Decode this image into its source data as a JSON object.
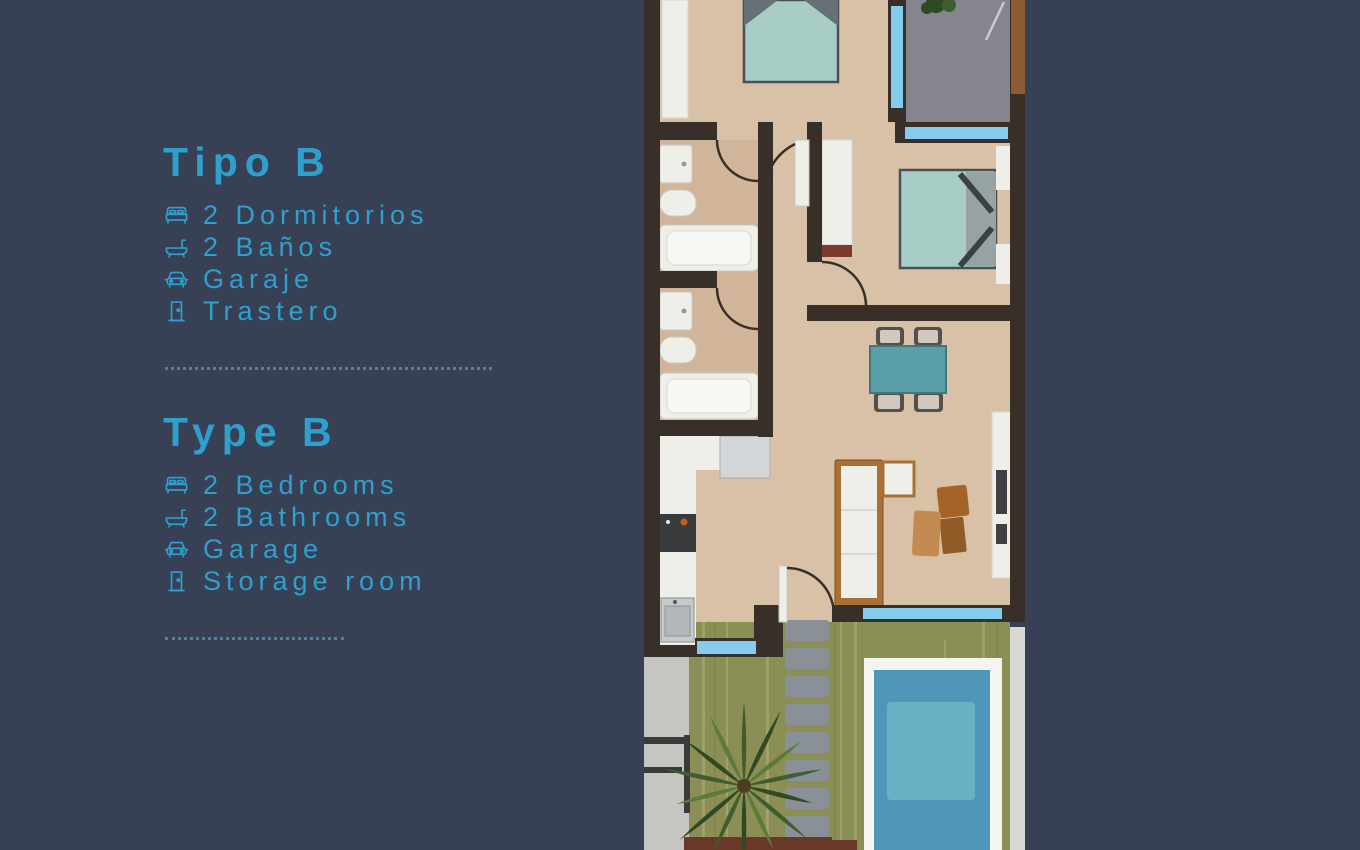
{
  "colors": {
    "bg": "#374054",
    "accent": "#2EA0CE",
    "divider": "#54809F",
    "wall": "#372F28",
    "floor": "#D9C1A8",
    "floor-bath": "#D1B59B",
    "white": "#EFEFEA",
    "window": "#85CBEE",
    "terrace": "#85858D",
    "bed": "#A7CDC6",
    "table": "#5B9FA8",
    "lawn": "#8B8F55",
    "leaf": "#3F5D2E",
    "leaf-dark": "#2F4A22",
    "leaf-light": "#5C7A3A",
    "pool": "#4E97B8",
    "pool-light": "#6FB9C6",
    "deck": "#F4F5F1",
    "stone": "#8A9097",
    "path": "#C5C5C2",
    "wood": "#A96F33",
    "chair-tan": "#C48B51",
    "chair-brown": "#A66328",
    "door-brown": "#8F5B33",
    "planter": "#693828",
    "dark-unit": "#3F4042",
    "gray-unit": "#D3D6D8",
    "headboard": "#667077",
    "railing": "#3A3A3A",
    "red-base": "#7A3B2C",
    "bed-gray": "#97A2A4",
    "chair-seat": "#CFC9C0",
    "chair-frame": "#57504A",
    "stove": "#3A3B3D",
    "steel": "#C6CACB"
  },
  "info_panel": {
    "sections": [
      {
        "heading": "Tipo B",
        "items": [
          {
            "icon": "bed-icon",
            "label": "2 Dormitorios"
          },
          {
            "icon": "bathtub-icon",
            "label": "2 Baños"
          },
          {
            "icon": "car-icon",
            "label": "Garaje"
          },
          {
            "icon": "storage-door-icon",
            "label": "Trastero"
          }
        ]
      },
      {
        "heading": "Type B",
        "items": [
          {
            "icon": "bed-icon",
            "label": "2 Bedrooms"
          },
          {
            "icon": "bathtub-icon",
            "label": "2 Bathrooms"
          },
          {
            "icon": "car-icon",
            "label": "Garage"
          },
          {
            "icon": "storage-door-icon",
            "label": "Storage room"
          }
        ]
      }
    ]
  },
  "floorplan": {
    "kind": "apartment floor plan illustration, top-down view",
    "depicted": [
      "two bedrooms with double beds",
      "two bathrooms (sink, toilet, bathtub)",
      "hallway",
      "living-dining room with table and sofa",
      "kitchen",
      "grey terrace",
      "garden lawn",
      "stepping-stone path",
      "palm tree",
      "swimming pool with white deck"
    ]
  }
}
